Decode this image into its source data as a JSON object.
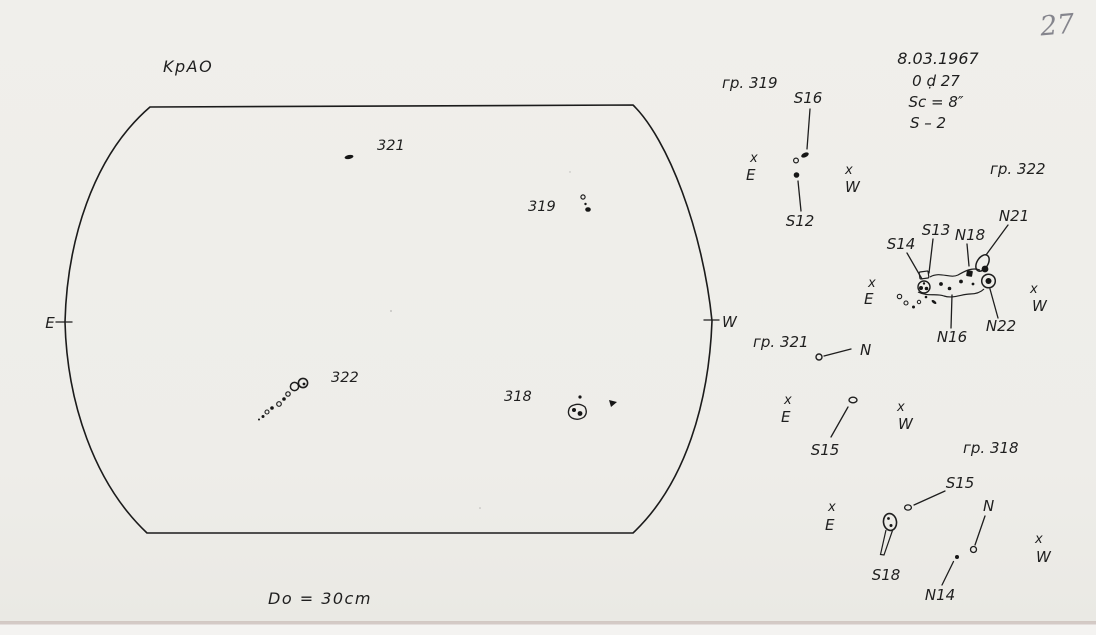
{
  "scan": {
    "page_number": "27"
  },
  "observatory": "KpAO",
  "header": {
    "date": "8.03.1967",
    "time": "0 ḍ 27",
    "seeing": "Sc = 8″",
    "quality": "S – 2"
  },
  "aperture_label": "Do = 30cm",
  "compass": {
    "x": "x",
    "e": "E",
    "w": "W"
  },
  "disk": {
    "east": "E",
    "west": "W",
    "group_labels": {
      "g321": "321",
      "g319": "319",
      "g322": "322",
      "g318": "318"
    }
  },
  "sketches": {
    "g319": {
      "title": "гр. 319",
      "s16": "S16",
      "s12": "S12"
    },
    "g322": {
      "title": "гр. 322",
      "s14": "S14",
      "s13": "S13",
      "n18": "N18",
      "n21": "N21",
      "n22": "N22",
      "n16": "N16"
    },
    "g321": {
      "title": "гр. 321",
      "n": "N",
      "s15": "S15"
    },
    "g318": {
      "title": "гр. 318",
      "s15": "S15",
      "n": "N",
      "s18": "S18",
      "n14": "N14"
    }
  }
}
